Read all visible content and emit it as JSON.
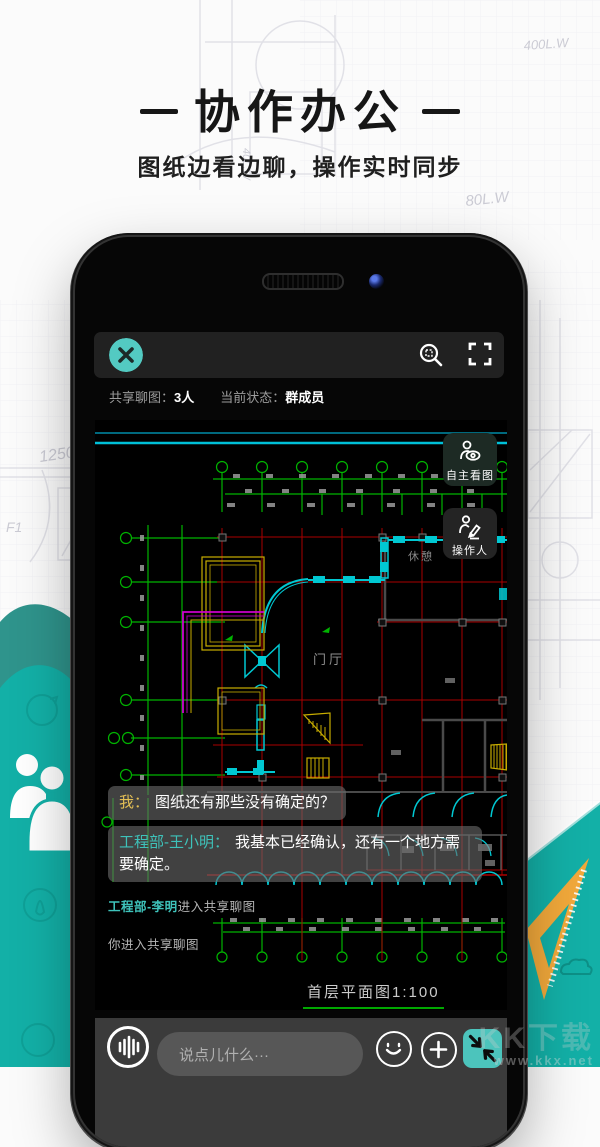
{
  "header": {
    "title": "协作办公",
    "subtitle": "图纸边看边聊，操作实时同步"
  },
  "phone": {
    "status": {
      "share_label": "共享聊图：",
      "share_count": "3人",
      "state_label": "当前状态：",
      "state_value": "群成员"
    },
    "side_buttons": {
      "view_free": "自主看图",
      "operator": "操作人"
    },
    "cad": {
      "hall_label": "门厅",
      "lounge_label": "休憩",
      "drawing_title": "首层平面图1:100"
    },
    "chat": {
      "messages": [
        {
          "sender": "我：",
          "text": "图纸还有那些没有确定的？"
        },
        {
          "sender": "工程部-王小明：",
          "text": "我基本已经确认，还有一个地方需要确定。"
        }
      ],
      "system": [
        {
          "name": "工程部-李明",
          "text": "进入共享聊图"
        },
        {
          "name": "",
          "text": "你进入共享聊图"
        }
      ]
    },
    "input": {
      "placeholder": "说点儿什么···"
    }
  },
  "background": {
    "labels": [
      "1250",
      "F1",
      "M2",
      "400L.W",
      "80L.W",
      "40L.W"
    ]
  },
  "watermark": {
    "logo": "KK下载",
    "url": "www.kkx.net"
  },
  "colors": {
    "accent_teal": "#13b0a7",
    "close_button": "#53cac2",
    "collapse_button": "#4cc4bc",
    "sender_me": "#e3bf55",
    "sender_peer": "#3ec2ba",
    "ruler_orange": "#f2a93b",
    "cad_green": "#00b400",
    "cad_red": "#aa0000",
    "cad_cyan": "#00c8d2"
  }
}
